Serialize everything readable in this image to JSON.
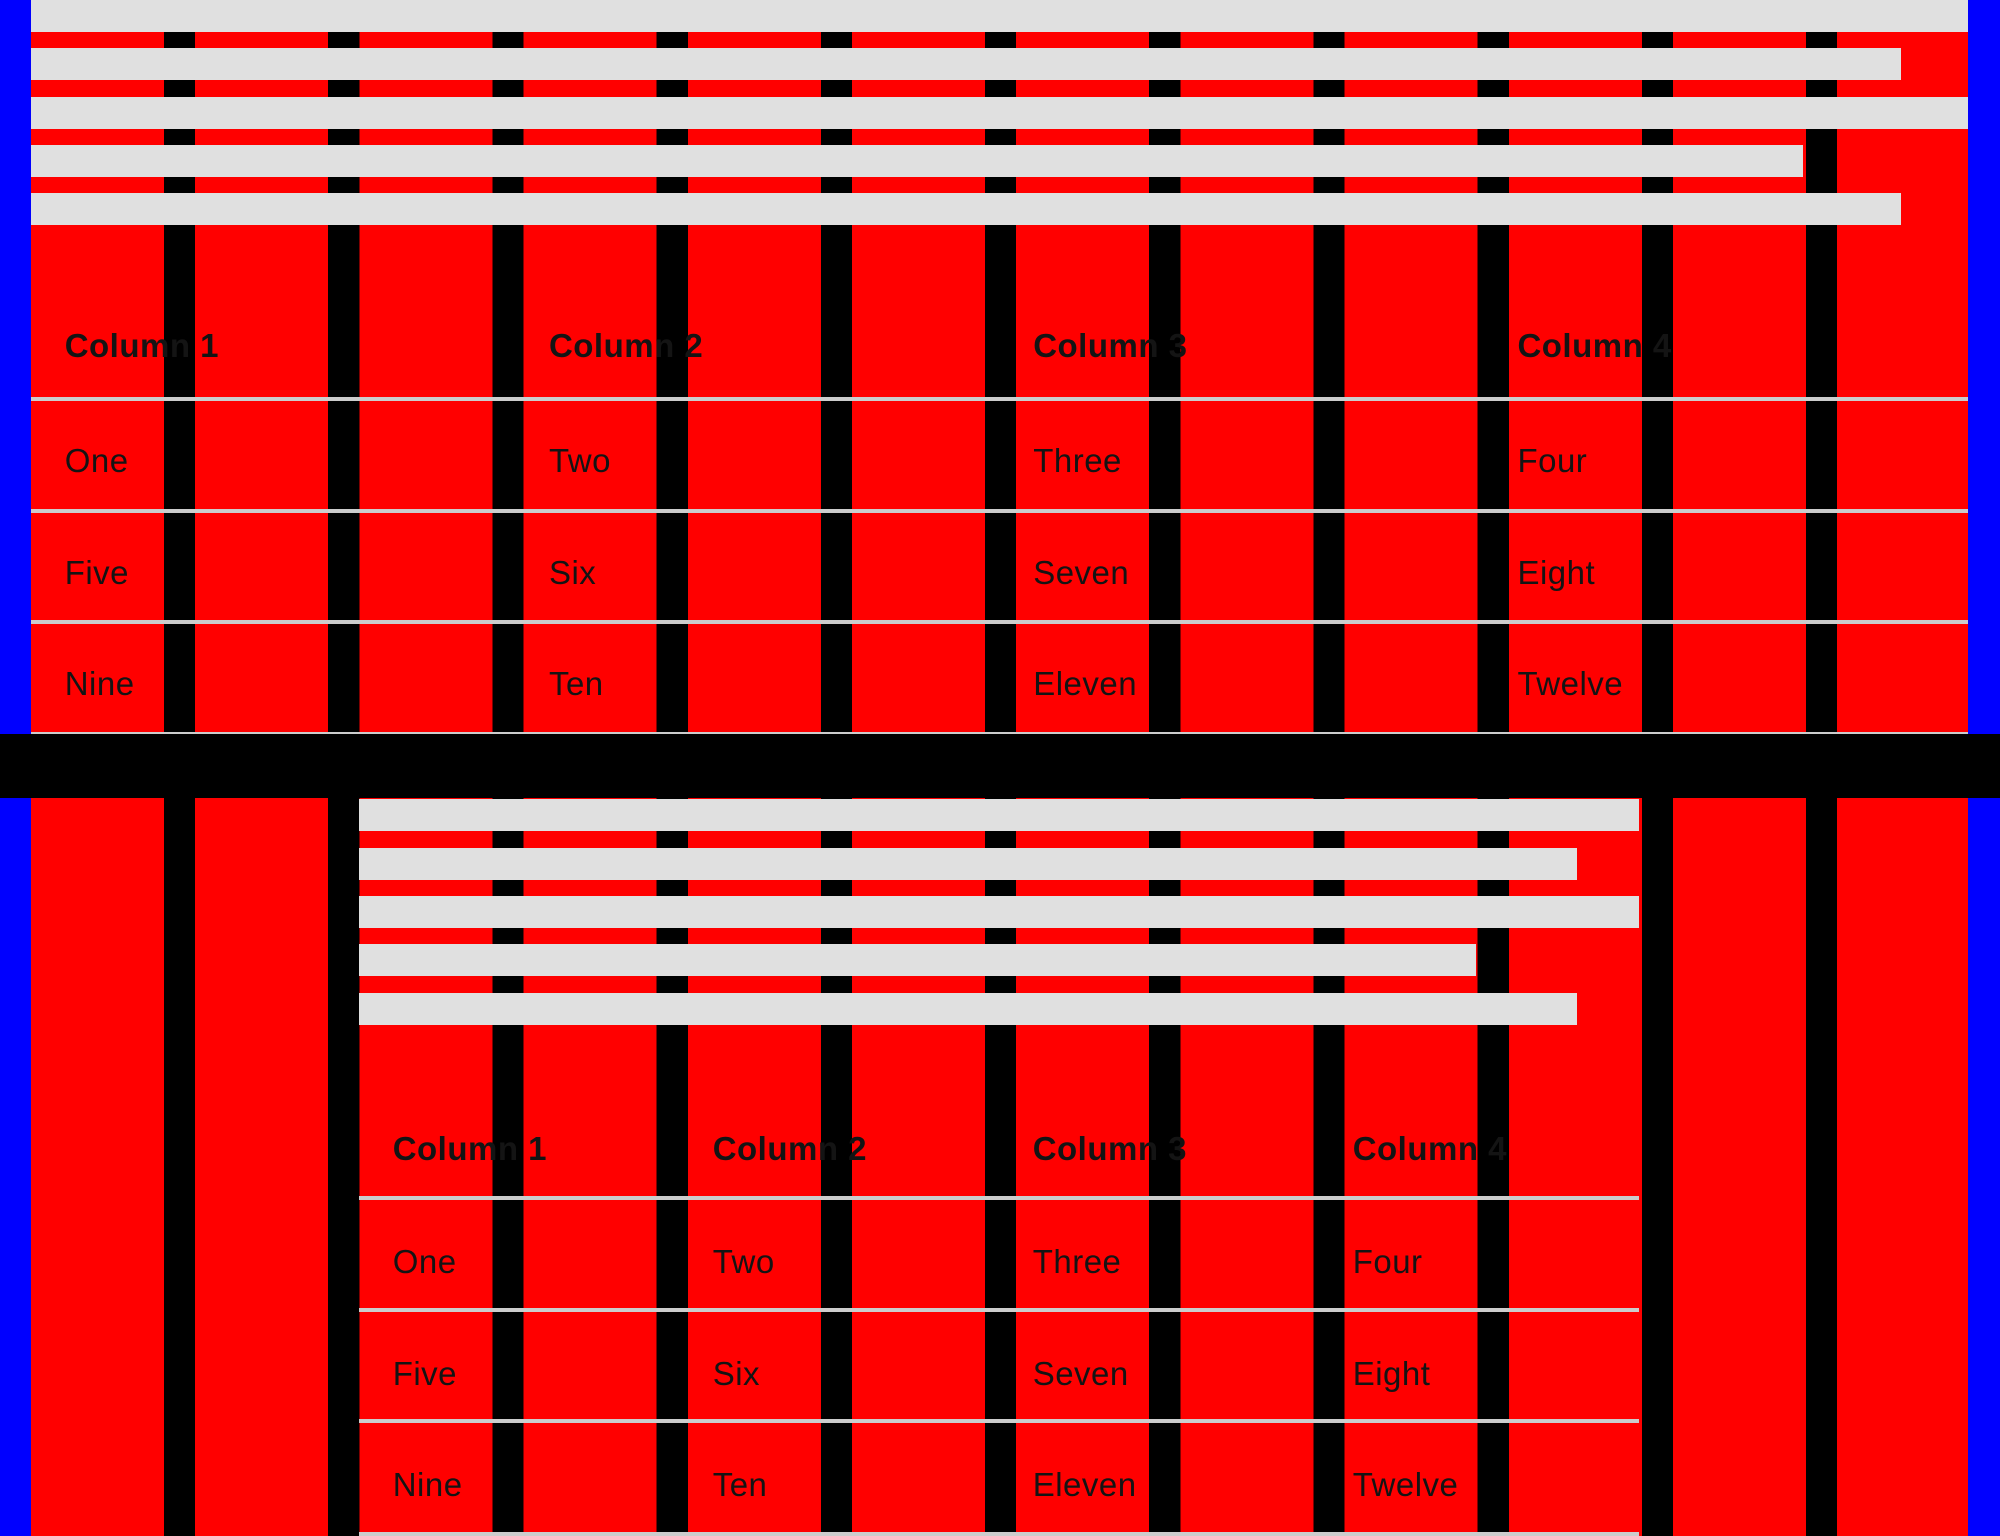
{
  "colors": {
    "page_background": "#0000ff",
    "content_background": "#ff0000",
    "stripe_color": "#000000",
    "skeleton_color": "#e0e0e0",
    "divider_color": "#cccccc",
    "separator_color": "#000000",
    "text_color": "#141414"
  },
  "sections": [
    {
      "table": {
        "headers": [
          "Column 1",
          "Column 2",
          "Column 3",
          "Column 4"
        ],
        "rows": [
          [
            "One",
            "Two",
            "Three",
            "Four"
          ],
          [
            "Five",
            "Six",
            "Seven",
            "Eight"
          ],
          [
            "Nine",
            "Ten",
            "Eleven",
            "Twelve"
          ]
        ]
      }
    },
    {
      "table": {
        "headers": [
          "Column 1",
          "Column 2",
          "Column 3",
          "Column 4"
        ],
        "rows": [
          [
            "One",
            "Two",
            "Three",
            "Four"
          ],
          [
            "Five",
            "Six",
            "Seven",
            "Eight"
          ],
          [
            "Nine",
            "Ten",
            "Eleven",
            "Twelve"
          ]
        ]
      }
    }
  ]
}
